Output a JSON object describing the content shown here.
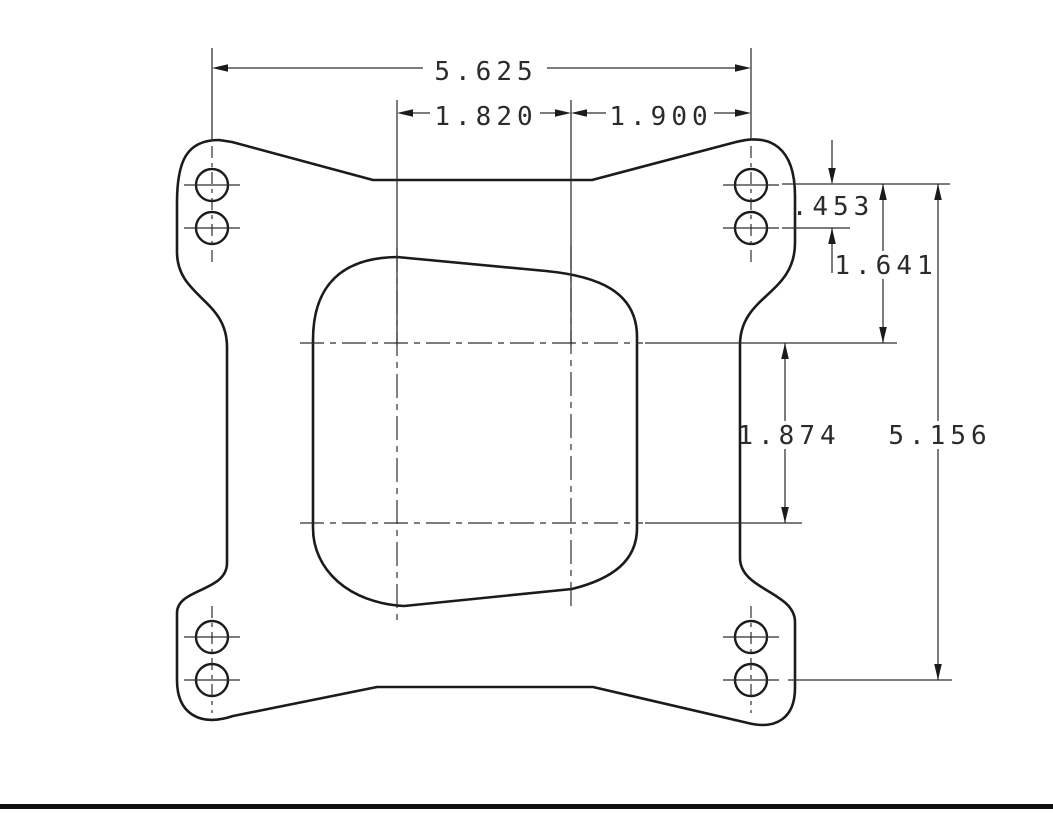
{
  "drawing": {
    "dimensions": {
      "overall_width": "5.625",
      "left_bore_spacing": "1.820",
      "right_bore_spacing": "1.900",
      "hole_offset": ".453",
      "top_row_to_centerline": "1.641",
      "bore_centerline_spacing": "1.874",
      "overall_height": "5.156"
    },
    "colors": {
      "line": "#1b1b1b",
      "background": "#ffffff",
      "footer_bar": "#0f0f0f"
    }
  }
}
